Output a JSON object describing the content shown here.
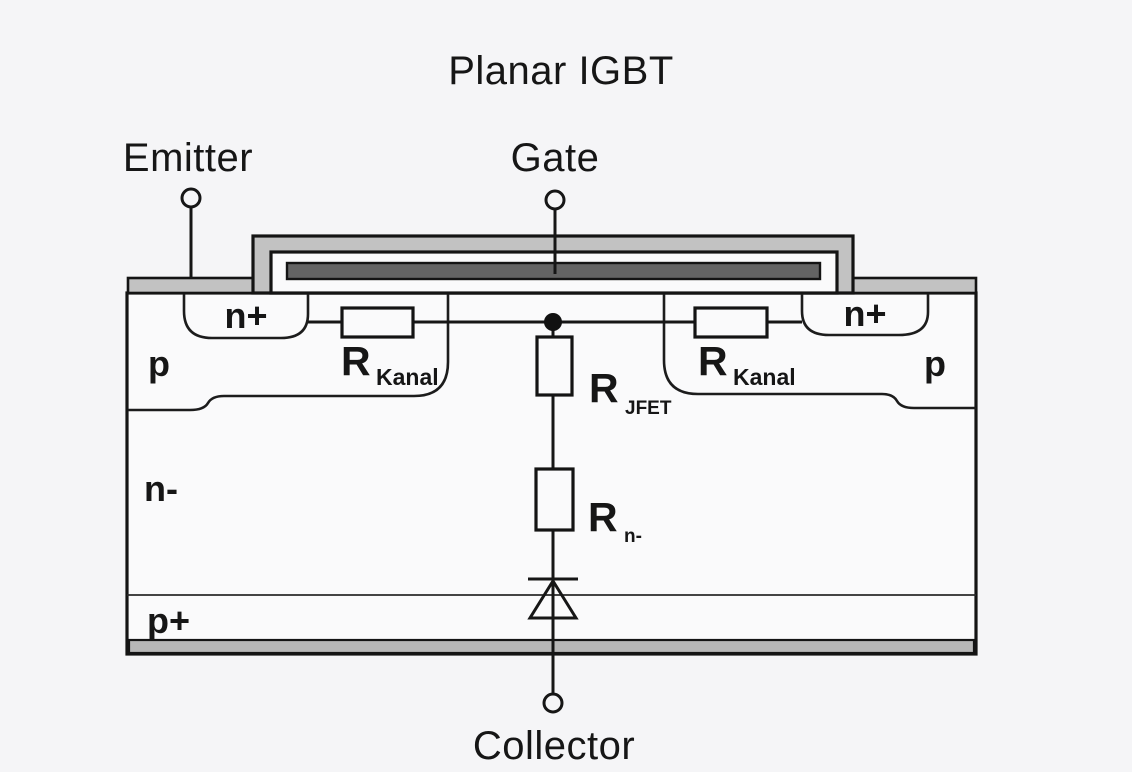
{
  "title": "Planar IGBT",
  "terminals": {
    "emitter": "Emitter",
    "gate": "Gate",
    "collector": "Collector"
  },
  "regions": {
    "n_plus_left": "n+",
    "n_plus_right": "n+",
    "p_left": "p",
    "p_right": "p",
    "n_minus": "n-",
    "p_plus": "p+"
  },
  "resistors": {
    "kanal_left": {
      "symbol": "R",
      "subscript": "Kanal"
    },
    "kanal_right": {
      "symbol": "R",
      "subscript": "Kanal"
    },
    "jfet": {
      "symbol": "R",
      "subscript": "JFET"
    },
    "n_drift": {
      "symbol": "R",
      "subscript": "n-"
    }
  },
  "colors": {
    "background": "#f5f5f7",
    "silicon": "#fafafb",
    "metal": "#c2c2c2",
    "metal_bottom": "#b7b7b7",
    "gate_poly": "#646464",
    "outline": "#161616"
  }
}
